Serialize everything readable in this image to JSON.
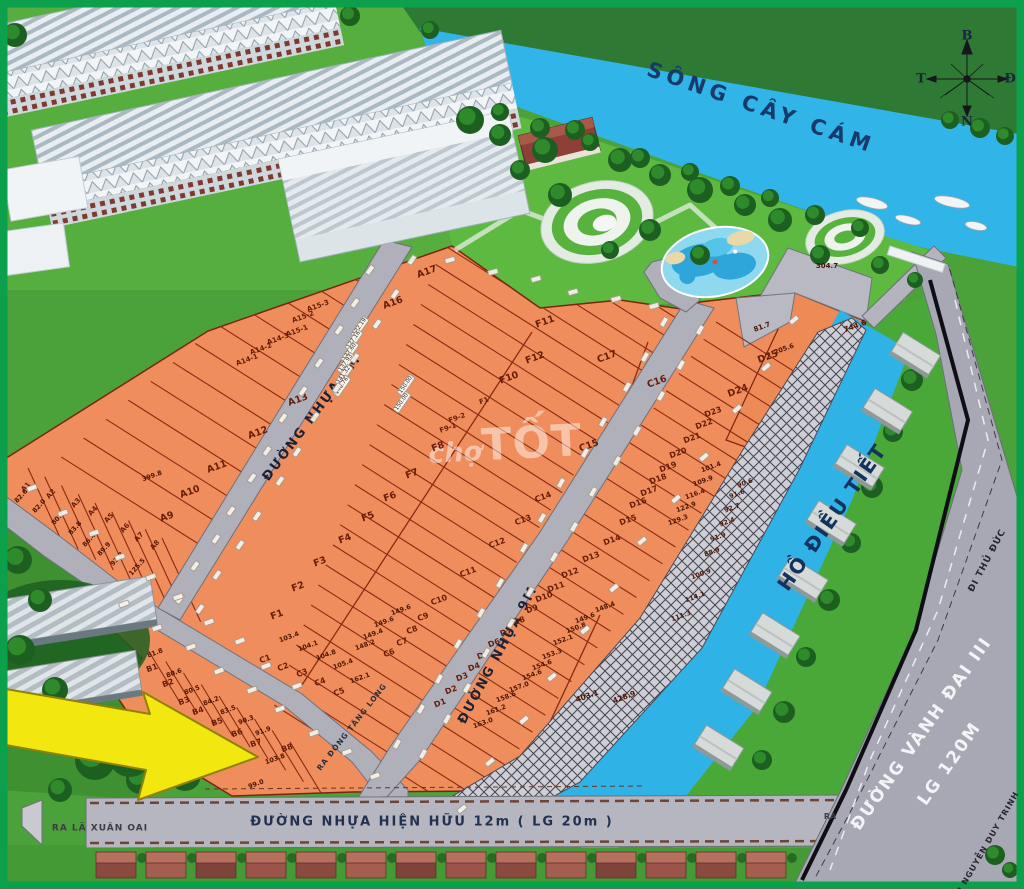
{
  "water": {
    "river_label": "SÔNG CÂY CÁM",
    "lake_label": "HỒ ĐIỀU TIẾT"
  },
  "roads": {
    "road_9m_a": "ĐƯỜNG NHỰA 9M",
    "road_9m_b": "ĐƯỜNG NHỰA 9M",
    "existing_road": "ĐƯỜNG NHỰA HIỆN HỮU 12m ( LG 20m )",
    "exit_left": "RA LÃ XUÂN OAI",
    "exit_right": "RA",
    "exit_dong_tang_long": "RA ĐÔNG TĂNG LONG",
    "ring_road_line1": "ĐƯỜNG VÀNH ĐAI III",
    "ring_road_line2": "LG 120M",
    "to_thu_duc": "ĐI THỦ ĐỨC",
    "to_nguyen_duy_trinh": "ĐI NGUYỄN DUY TRINH"
  },
  "compass": {
    "n": "B",
    "s": "N",
    "w": "T",
    "e": "Đ"
  },
  "watermark": {
    "small": "chợ",
    "big": "TỐT"
  },
  "colors": {
    "plot_orange": "#ef8e5c",
    "water_blue": "#31b5e8",
    "grass": "#4ba23a",
    "road_gray": "#b0b0ba",
    "frame_green": "#0ca04d",
    "arrow_yellow": "#f2e70e"
  },
  "plot_labels": [
    {
      "t": "A17",
      "x": 427,
      "y": 272
    },
    {
      "t": "A16",
      "x": 393,
      "y": 303
    },
    {
      "t": "A15-3",
      "x": 318,
      "y": 306,
      "s": 7
    },
    {
      "t": "A15-2",
      "x": 303,
      "y": 317,
      "s": 7
    },
    {
      "t": "A15-1",
      "x": 297,
      "y": 331,
      "s": 7
    },
    {
      "t": "A14-3",
      "x": 278,
      "y": 339,
      "s": 7
    },
    {
      "t": "A14-2",
      "x": 261,
      "y": 349,
      "s": 7
    },
    {
      "t": "A14-1",
      "x": 247,
      "y": 360,
      "s": 7
    },
    {
      "t": "A13",
      "x": 298,
      "y": 400
    },
    {
      "t": "A12",
      "x": 258,
      "y": 433
    },
    {
      "t": "A11",
      "x": 217,
      "y": 467
    },
    {
      "t": "A10",
      "x": 190,
      "y": 492
    },
    {
      "t": "A9",
      "x": 167,
      "y": 517
    },
    {
      "t": "A8",
      "x": 155,
      "y": 545,
      "r": -48,
      "s": 7
    },
    {
      "t": "A7",
      "x": 139,
      "y": 537,
      "r": -48,
      "s": 7
    },
    {
      "t": "A6",
      "x": 125,
      "y": 528,
      "r": -48,
      "s": 7
    },
    {
      "t": "A5",
      "x": 109,
      "y": 518,
      "r": -48,
      "s": 7
    },
    {
      "t": "A4",
      "x": 93,
      "y": 511,
      "r": -48,
      "s": 7
    },
    {
      "t": "A3",
      "x": 76,
      "y": 503,
      "r": -48,
      "s": 7
    },
    {
      "t": "A2",
      "x": 51,
      "y": 494,
      "r": -48,
      "s": 7
    },
    {
      "t": "A1",
      "x": 26,
      "y": 487,
      "r": -48,
      "s": 7
    },
    {
      "t": "B1",
      "x": 152,
      "y": 668,
      "s": 8
    },
    {
      "t": "B2",
      "x": 168,
      "y": 683,
      "s": 8
    },
    {
      "t": "B3",
      "x": 184,
      "y": 701,
      "s": 8
    },
    {
      "t": "B4",
      "x": 198,
      "y": 711,
      "s": 8
    },
    {
      "t": "B5",
      "x": 217,
      "y": 722,
      "s": 8
    },
    {
      "t": "B6",
      "x": 237,
      "y": 733,
      "s": 8
    },
    {
      "t": "B7",
      "x": 256,
      "y": 743,
      "s": 8
    },
    {
      "t": "B8",
      "x": 287,
      "y": 748,
      "s": 8
    },
    {
      "t": "F11",
      "x": 545,
      "y": 322
    },
    {
      "t": "F12",
      "x": 535,
      "y": 358
    },
    {
      "t": "F10",
      "x": 509,
      "y": 378
    },
    {
      "t": "F1",
      "x": 484,
      "y": 401,
      "s": 7
    },
    {
      "t": "F9-2",
      "x": 457,
      "y": 418,
      "s": 7
    },
    {
      "t": "F9-1",
      "x": 448,
      "y": 428,
      "s": 7
    },
    {
      "t": "F8",
      "x": 438,
      "y": 447
    },
    {
      "t": "F7",
      "x": 412,
      "y": 474
    },
    {
      "t": "F6",
      "x": 390,
      "y": 497
    },
    {
      "t": "F5",
      "x": 368,
      "y": 517
    },
    {
      "t": "F4",
      "x": 345,
      "y": 539
    },
    {
      "t": "F3",
      "x": 320,
      "y": 562
    },
    {
      "t": "F2",
      "x": 298,
      "y": 587
    },
    {
      "t": "F1",
      "x": 277,
      "y": 615
    },
    {
      "t": "C17",
      "x": 607,
      "y": 357
    },
    {
      "t": "C16",
      "x": 657,
      "y": 382
    },
    {
      "t": "C15",
      "x": 589,
      "y": 446
    },
    {
      "t": "C14",
      "x": 543,
      "y": 497,
      "s": 8
    },
    {
      "t": "C13",
      "x": 523,
      "y": 520,
      "s": 8
    },
    {
      "t": "C12",
      "x": 497,
      "y": 543,
      "s": 8
    },
    {
      "t": "C11",
      "x": 468,
      "y": 572,
      "s": 8
    },
    {
      "t": "C10",
      "x": 439,
      "y": 600,
      "s": 8
    },
    {
      "t": "C9",
      "x": 423,
      "y": 617,
      "s": 8
    },
    {
      "t": "C8",
      "x": 412,
      "y": 630,
      "s": 8
    },
    {
      "t": "C7",
      "x": 402,
      "y": 642,
      "s": 8
    },
    {
      "t": "C6",
      "x": 389,
      "y": 653,
      "s": 8
    },
    {
      "t": "C5",
      "x": 339,
      "y": 692,
      "s": 8
    },
    {
      "t": "C4",
      "x": 320,
      "y": 682,
      "s": 8
    },
    {
      "t": "C3",
      "x": 302,
      "y": 673,
      "s": 8
    },
    {
      "t": "C2",
      "x": 283,
      "y": 667,
      "s": 8
    },
    {
      "t": "C1",
      "x": 265,
      "y": 659,
      "s": 8
    },
    {
      "t": "D25",
      "x": 768,
      "y": 357
    },
    {
      "t": "D24",
      "x": 738,
      "y": 391
    },
    {
      "t": "D23",
      "x": 713,
      "y": 412,
      "s": 8
    },
    {
      "t": "D22",
      "x": 704,
      "y": 424,
      "s": 8
    },
    {
      "t": "D21",
      "x": 692,
      "y": 438,
      "s": 8
    },
    {
      "t": "D20",
      "x": 678,
      "y": 453,
      "s": 8
    },
    {
      "t": "D19",
      "x": 668,
      "y": 467,
      "s": 8
    },
    {
      "t": "D18",
      "x": 658,
      "y": 479,
      "s": 8
    },
    {
      "t": "D17",
      "x": 649,
      "y": 491,
      "s": 8
    },
    {
      "t": "D16",
      "x": 638,
      "y": 503,
      "s": 8
    },
    {
      "t": "D15",
      "x": 628,
      "y": 520,
      "s": 8
    },
    {
      "t": "D14",
      "x": 612,
      "y": 540,
      "s": 8
    },
    {
      "t": "D13",
      "x": 591,
      "y": 557,
      "s": 8
    },
    {
      "t": "D12",
      "x": 570,
      "y": 573,
      "s": 8
    },
    {
      "t": "D11",
      "x": 556,
      "y": 587,
      "s": 8
    },
    {
      "t": "D10",
      "x": 544,
      "y": 597,
      "s": 8
    },
    {
      "t": "D9",
      "x": 532,
      "y": 609,
      "s": 8
    },
    {
      "t": "D8",
      "x": 519,
      "y": 621,
      "s": 8
    },
    {
      "t": "D7",
      "x": 506,
      "y": 632,
      "s": 8
    },
    {
      "t": "D6",
      "x": 494,
      "y": 643,
      "s": 8
    },
    {
      "t": "D5",
      "x": 483,
      "y": 655,
      "s": 8
    },
    {
      "t": "D4",
      "x": 474,
      "y": 667,
      "s": 8
    },
    {
      "t": "D3",
      "x": 462,
      "y": 677,
      "s": 8
    },
    {
      "t": "D2",
      "x": 451,
      "y": 690,
      "s": 8
    },
    {
      "t": "D1",
      "x": 440,
      "y": 703,
      "s": 8
    }
  ],
  "plot_areas": [
    {
      "t": "399.8",
      "x": 152,
      "y": 476
    },
    {
      "t": "82.6",
      "x": 21,
      "y": 496,
      "r": -48
    },
    {
      "t": "82.0",
      "x": 39,
      "y": 506,
      "r": -48
    },
    {
      "t": "80.7",
      "x": 58,
      "y": 518,
      "r": -48
    },
    {
      "t": "83.8",
      "x": 75,
      "y": 528,
      "r": -48
    },
    {
      "t": "86.4",
      "x": 89,
      "y": 540,
      "r": -48
    },
    {
      "t": "89.9",
      "x": 104,
      "y": 549,
      "r": -48
    },
    {
      "t": "93.3",
      "x": 117,
      "y": 559,
      "r": -48
    },
    {
      "t": "125.5",
      "x": 137,
      "y": 567,
      "r": -48
    },
    {
      "t": "81.8",
      "x": 155,
      "y": 653
    },
    {
      "t": "80.6",
      "x": 174,
      "y": 673
    },
    {
      "t": "80.5",
      "x": 192,
      "y": 690
    },
    {
      "t": "84.2",
      "x": 211,
      "y": 701
    },
    {
      "t": "83.5",
      "x": 228,
      "y": 710
    },
    {
      "t": "90.3",
      "x": 246,
      "y": 720
    },
    {
      "t": "91.9",
      "x": 263,
      "y": 731
    },
    {
      "t": "103.8",
      "x": 275,
      "y": 759
    },
    {
      "t": "99.0",
      "x": 256,
      "y": 784
    },
    {
      "t": "149.6",
      "x": 401,
      "y": 610
    },
    {
      "t": "149.6",
      "x": 384,
      "y": 622
    },
    {
      "t": "149.4",
      "x": 373,
      "y": 634
    },
    {
      "t": "148.2",
      "x": 365,
      "y": 645
    },
    {
      "t": "103.4",
      "x": 289,
      "y": 637
    },
    {
      "t": "104.1",
      "x": 308,
      "y": 646
    },
    {
      "t": "104.8",
      "x": 326,
      "y": 655
    },
    {
      "t": "105.4",
      "x": 343,
      "y": 664
    },
    {
      "t": "162.1",
      "x": 360,
      "y": 678
    },
    {
      "t": "205.6",
      "x": 784,
      "y": 349
    },
    {
      "t": "101.4",
      "x": 711,
      "y": 467
    },
    {
      "t": "109.9",
      "x": 703,
      "y": 481
    },
    {
      "t": "116.4",
      "x": 695,
      "y": 494
    },
    {
      "t": "122.9",
      "x": 686,
      "y": 507
    },
    {
      "t": "129.3",
      "x": 678,
      "y": 520
    },
    {
      "t": "148.4",
      "x": 605,
      "y": 607
    },
    {
      "t": "149.6",
      "x": 585,
      "y": 618
    },
    {
      "t": "150.8",
      "x": 576,
      "y": 628
    },
    {
      "t": "152.1",
      "x": 563,
      "y": 640
    },
    {
      "t": "153.3",
      "x": 552,
      "y": 654
    },
    {
      "t": "154.6",
      "x": 542,
      "y": 665
    },
    {
      "t": "154.6",
      "x": 532,
      "y": 675
    },
    {
      "t": "157.0",
      "x": 519,
      "y": 687
    },
    {
      "t": "158.6",
      "x": 506,
      "y": 697
    },
    {
      "t": "161.2",
      "x": 496,
      "y": 710
    },
    {
      "t": "163.0",
      "x": 483,
      "y": 723
    },
    {
      "t": "90.6",
      "x": 745,
      "y": 483
    },
    {
      "t": "91.6",
      "x": 737,
      "y": 494
    },
    {
      "t": "92.7",
      "x": 732,
      "y": 508
    },
    {
      "t": "92.4",
      "x": 727,
      "y": 522
    },
    {
      "t": "91.9",
      "x": 718,
      "y": 537
    },
    {
      "t": "88.9",
      "x": 712,
      "y": 552
    },
    {
      "t": "100.9",
      "x": 701,
      "y": 574
    },
    {
      "t": "114.1",
      "x": 695,
      "y": 597
    },
    {
      "t": "111.3",
      "x": 681,
      "y": 616
    },
    {
      "t": "744.6",
      "x": 855,
      "y": 326,
      "s": 7.5
    },
    {
      "t": "403.1",
      "x": 587,
      "y": 696,
      "s": 7.5
    },
    {
      "t": "428.9",
      "x": 624,
      "y": 697,
      "s": 7.5
    },
    {
      "t": "304.7",
      "x": 827,
      "y": 266,
      "r": 0,
      "s": 7
    },
    {
      "t": "81.7",
      "x": 762,
      "y": 327,
      "s": 7
    }
  ],
  "dimension_tags": [
    {
      "t": "122.19",
      "x": 360,
      "y": 327
    },
    {
      "t": "127.16",
      "x": 354,
      "y": 340
    },
    {
      "t": "132.60",
      "x": 350,
      "y": 352
    },
    {
      "t": "137.93",
      "x": 346,
      "y": 363
    },
    {
      "t": "141.32",
      "x": 344,
      "y": 375
    },
    {
      "t": "148.76",
      "x": 342,
      "y": 386
    },
    {
      "t": "150.00",
      "x": 406,
      "y": 385
    },
    {
      "t": "150.00",
      "x": 402,
      "y": 402
    }
  ]
}
